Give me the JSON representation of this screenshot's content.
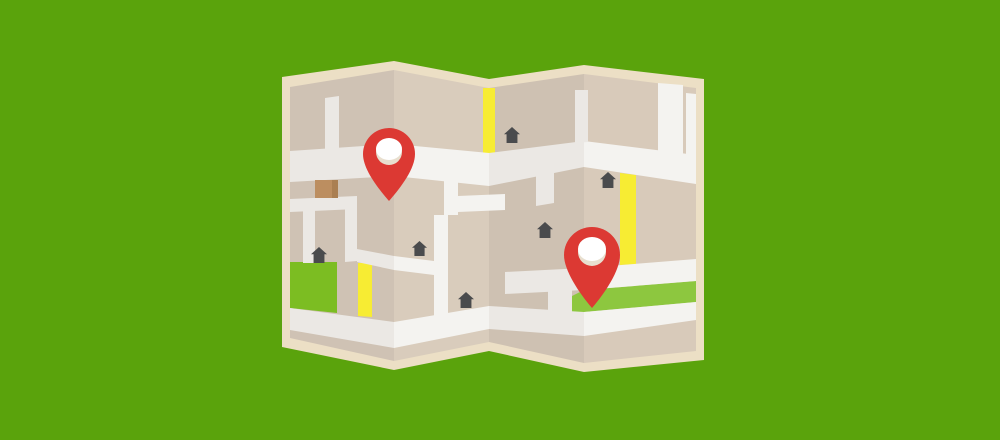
{
  "canvas": {
    "width": 1000,
    "height": 440
  },
  "colors": {
    "background": "#5aa30c",
    "paper_border": "#ecdfc5",
    "panel_1": "#cfc2b4",
    "panel_2": "#d9ccbc",
    "panel_3": "#cec1b2",
    "panel_4": "#d8caba",
    "road_dark": "#ebe8e4",
    "road_light": "#f4f3f0",
    "road_yellow": "#f7ec33",
    "park_left": "#7cbd22",
    "park_stripe": "#8dc73f",
    "building_brown": "#bc8e60",
    "building_brown_shade": "#aa7f52",
    "house_icon": "#4a4b4d",
    "pin_red": "#dc3933",
    "pin_hole": "#ffffff",
    "pin_hole_shade": "#e8dfcf"
  },
  "illustration": {
    "name": "folded-paper-map-with-location-pins",
    "shapes": [
      {
        "name": "background",
        "fill": "background",
        "points": [
          [
            0,
            0
          ],
          [
            1000,
            0
          ],
          [
            1000,
            440
          ],
          [
            0,
            440
          ]
        ]
      },
      {
        "name": "paper-border",
        "fill": "paper_border",
        "points": [
          [
            282,
            77
          ],
          [
            394,
            61
          ],
          [
            489,
            79
          ],
          [
            584,
            65
          ],
          [
            704,
            79
          ],
          [
            704,
            360
          ],
          [
            584,
            372
          ],
          [
            489,
            351
          ],
          [
            394,
            370
          ],
          [
            282,
            347
          ]
        ]
      },
      {
        "name": "map-panel-1",
        "fill": "panel_1",
        "points": [
          [
            290,
            87
          ],
          [
            394,
            70
          ],
          [
            394,
            361
          ],
          [
            290,
            338
          ]
        ]
      },
      {
        "name": "map-panel-2",
        "fill": "panel_2",
        "points": [
          [
            394,
            70
          ],
          [
            489,
            88
          ],
          [
            489,
            342
          ],
          [
            394,
            361
          ]
        ]
      },
      {
        "name": "map-panel-3",
        "fill": "panel_3",
        "points": [
          [
            489,
            88
          ],
          [
            584,
            74
          ],
          [
            584,
            363
          ],
          [
            489,
            342
          ]
        ]
      },
      {
        "name": "map-panel-4",
        "fill": "panel_4",
        "points": [
          [
            584,
            74
          ],
          [
            696,
            88
          ],
          [
            696,
            351
          ],
          [
            584,
            363
          ]
        ]
      },
      {
        "name": "park-left",
        "fill": "park_left",
        "points": [
          [
            290,
            262
          ],
          [
            337,
            262
          ],
          [
            337,
            313
          ],
          [
            290,
            308
          ]
        ]
      },
      {
        "name": "park-stripe",
        "fill": "park_stripe",
        "points": [
          [
            572,
            296
          ],
          [
            584,
            290
          ],
          [
            696,
            281
          ],
          [
            696,
            302
          ],
          [
            584,
            312
          ],
          [
            572,
            317
          ]
        ]
      },
      {
        "name": "yellow-road-fold2",
        "fill": "road_yellow",
        "points": [
          [
            483,
            88
          ],
          [
            495,
            88
          ],
          [
            495,
            153
          ],
          [
            483,
            153
          ]
        ]
      },
      {
        "name": "yellow-road-panel1",
        "fill": "road_yellow",
        "points": [
          [
            358,
            263
          ],
          [
            372,
            263
          ],
          [
            372,
            317
          ],
          [
            358,
            316
          ]
        ]
      },
      {
        "name": "yellow-road-panel4",
        "fill": "road_yellow",
        "points": [
          [
            620,
            173
          ],
          [
            636,
            175
          ],
          [
            636,
            264
          ],
          [
            620,
            265
          ]
        ]
      },
      {
        "name": "main-road-panel1",
        "fill": "road_dark",
        "points": [
          [
            290,
            151
          ],
          [
            394,
            144
          ],
          [
            394,
            176
          ],
          [
            290,
            182
          ]
        ]
      },
      {
        "name": "main-road-panel2",
        "fill": "road_light",
        "points": [
          [
            394,
            144
          ],
          [
            489,
            153
          ],
          [
            489,
            186
          ],
          [
            394,
            176
          ]
        ]
      },
      {
        "name": "main-road-panel3",
        "fill": "road_dark",
        "points": [
          [
            489,
            153
          ],
          [
            584,
            141
          ],
          [
            584,
            167
          ],
          [
            489,
            186
          ]
        ]
      },
      {
        "name": "main-road-panel4",
        "fill": "road_light",
        "points": [
          [
            584,
            141
          ],
          [
            696,
            155
          ],
          [
            696,
            184
          ],
          [
            584,
            167
          ]
        ]
      },
      {
        "name": "bottom-road-panel1",
        "fill": "road_dark",
        "points": [
          [
            290,
            308
          ],
          [
            394,
            322
          ],
          [
            394,
            348
          ],
          [
            290,
            330
          ]
        ]
      },
      {
        "name": "bottom-road-panel2",
        "fill": "road_light",
        "points": [
          [
            394,
            322
          ],
          [
            489,
            306
          ],
          [
            489,
            329
          ],
          [
            394,
            348
          ]
        ]
      },
      {
        "name": "bottom-road-panel3",
        "fill": "road_dark",
        "points": [
          [
            489,
            306
          ],
          [
            584,
            312
          ],
          [
            584,
            336
          ],
          [
            489,
            329
          ]
        ]
      },
      {
        "name": "bottom-road-panel4",
        "fill": "road_light",
        "points": [
          [
            584,
            312
          ],
          [
            696,
            302
          ],
          [
            696,
            320
          ],
          [
            584,
            336
          ]
        ]
      },
      {
        "name": "road-panel1-top-vertical",
        "fill": "road_dark",
        "points": [
          [
            325,
            98
          ],
          [
            339,
            96
          ],
          [
            339,
            152
          ],
          [
            325,
            153
          ]
        ]
      },
      {
        "name": "road-panel1-mid-horizontal",
        "fill": "road_dark",
        "points": [
          [
            290,
            199
          ],
          [
            357,
            196
          ],
          [
            357,
            209
          ],
          [
            290,
            212
          ]
        ]
      },
      {
        "name": "road-panel1-mid-vertical",
        "fill": "road_dark",
        "points": [
          [
            303,
            204
          ],
          [
            315,
            203
          ],
          [
            315,
            263
          ],
          [
            303,
            263
          ]
        ]
      },
      {
        "name": "road-panel1-right-vertical",
        "fill": "road_dark",
        "points": [
          [
            345,
            207
          ],
          [
            357,
            206
          ],
          [
            357,
            261
          ],
          [
            345,
            262
          ]
        ]
      },
      {
        "name": "road-panel1-cross-arm",
        "fill": "road_dark",
        "points": [
          [
            357,
            249
          ],
          [
            394,
            256
          ],
          [
            394,
            270
          ],
          [
            357,
            262
          ]
        ]
      },
      {
        "name": "road-panel2-cross-arm",
        "fill": "road_light",
        "points": [
          [
            394,
            256
          ],
          [
            434,
            261
          ],
          [
            434,
            275
          ],
          [
            394,
            270
          ]
        ]
      },
      {
        "name": "road-panel2-left-vertical",
        "fill": "road_light",
        "points": [
          [
            434,
            215
          ],
          [
            448,
            215
          ],
          [
            448,
            318
          ],
          [
            434,
            316
          ]
        ]
      },
      {
        "name": "road-panel2-branch-vertical",
        "fill": "road_light",
        "points": [
          [
            444,
            174
          ],
          [
            458,
            176
          ],
          [
            458,
            215
          ],
          [
            444,
            215
          ]
        ]
      },
      {
        "name": "road-panel2-branch-horizontal",
        "fill": "road_light",
        "points": [
          [
            458,
            196
          ],
          [
            505,
            194
          ],
          [
            505,
            210
          ],
          [
            458,
            212
          ]
        ]
      },
      {
        "name": "road-panel3-upper-vertical",
        "fill": "road_dark",
        "points": [
          [
            536,
            171
          ],
          [
            554,
            168
          ],
          [
            554,
            203
          ],
          [
            536,
            206
          ]
        ]
      },
      {
        "name": "road-fold3-vertical",
        "fill": "road_dark",
        "points": [
          [
            575,
            90
          ],
          [
            588,
            90
          ],
          [
            588,
            142
          ],
          [
            575,
            143
          ]
        ]
      },
      {
        "name": "road-panel3-lower-horizontal",
        "fill": "road_dark",
        "points": [
          [
            505,
            272
          ],
          [
            584,
            268
          ],
          [
            584,
            290
          ],
          [
            505,
            294
          ]
        ]
      },
      {
        "name": "road-panel3-lower-vertical",
        "fill": "road_dark",
        "points": [
          [
            548,
            290
          ],
          [
            572,
            288
          ],
          [
            572,
            314
          ],
          [
            548,
            316
          ]
        ]
      },
      {
        "name": "road-panel4-diagonal",
        "fill": "road_light",
        "points": [
          [
            584,
            268
          ],
          [
            696,
            259
          ],
          [
            696,
            281
          ],
          [
            584,
            290
          ]
        ]
      },
      {
        "name": "road-panel4-top-vertical",
        "fill": "road_light",
        "points": [
          [
            658,
            83
          ],
          [
            683,
            85
          ],
          [
            683,
            154
          ],
          [
            658,
            151
          ]
        ]
      },
      {
        "name": "road-panel4-edge-vertical",
        "fill": "road_light",
        "points": [
          [
            686,
            93
          ],
          [
            696,
            94
          ],
          [
            696,
            156
          ],
          [
            686,
            154
          ]
        ]
      },
      {
        "name": "building-brown",
        "fill": "building_brown",
        "points": [
          [
            315,
            180
          ],
          [
            338,
            180
          ],
          [
            338,
            198
          ],
          [
            315,
            198
          ]
        ]
      },
      {
        "name": "building-brown-shade",
        "fill": "building_brown_shade",
        "points": [
          [
            332,
            180
          ],
          [
            338,
            180
          ],
          [
            338,
            198
          ],
          [
            332,
            198
          ]
        ]
      }
    ],
    "houses": [
      {
        "x": 311,
        "y": 247,
        "size": 16
      },
      {
        "x": 412,
        "y": 241,
        "size": 15
      },
      {
        "x": 537,
        "y": 222,
        "size": 16
      },
      {
        "x": 504,
        "y": 127,
        "size": 16
      },
      {
        "x": 600,
        "y": 172,
        "size": 16
      },
      {
        "x": 458,
        "y": 292,
        "size": 16
      }
    ],
    "pins": [
      {
        "cx": 389,
        "cy": 154,
        "r": 26,
        "tip": 201,
        "hole_cy": 152,
        "hole_r": 13
      },
      {
        "cx": 592,
        "cy": 255,
        "r": 28,
        "tip": 308,
        "hole_cy": 252,
        "hole_r": 14
      }
    ]
  }
}
